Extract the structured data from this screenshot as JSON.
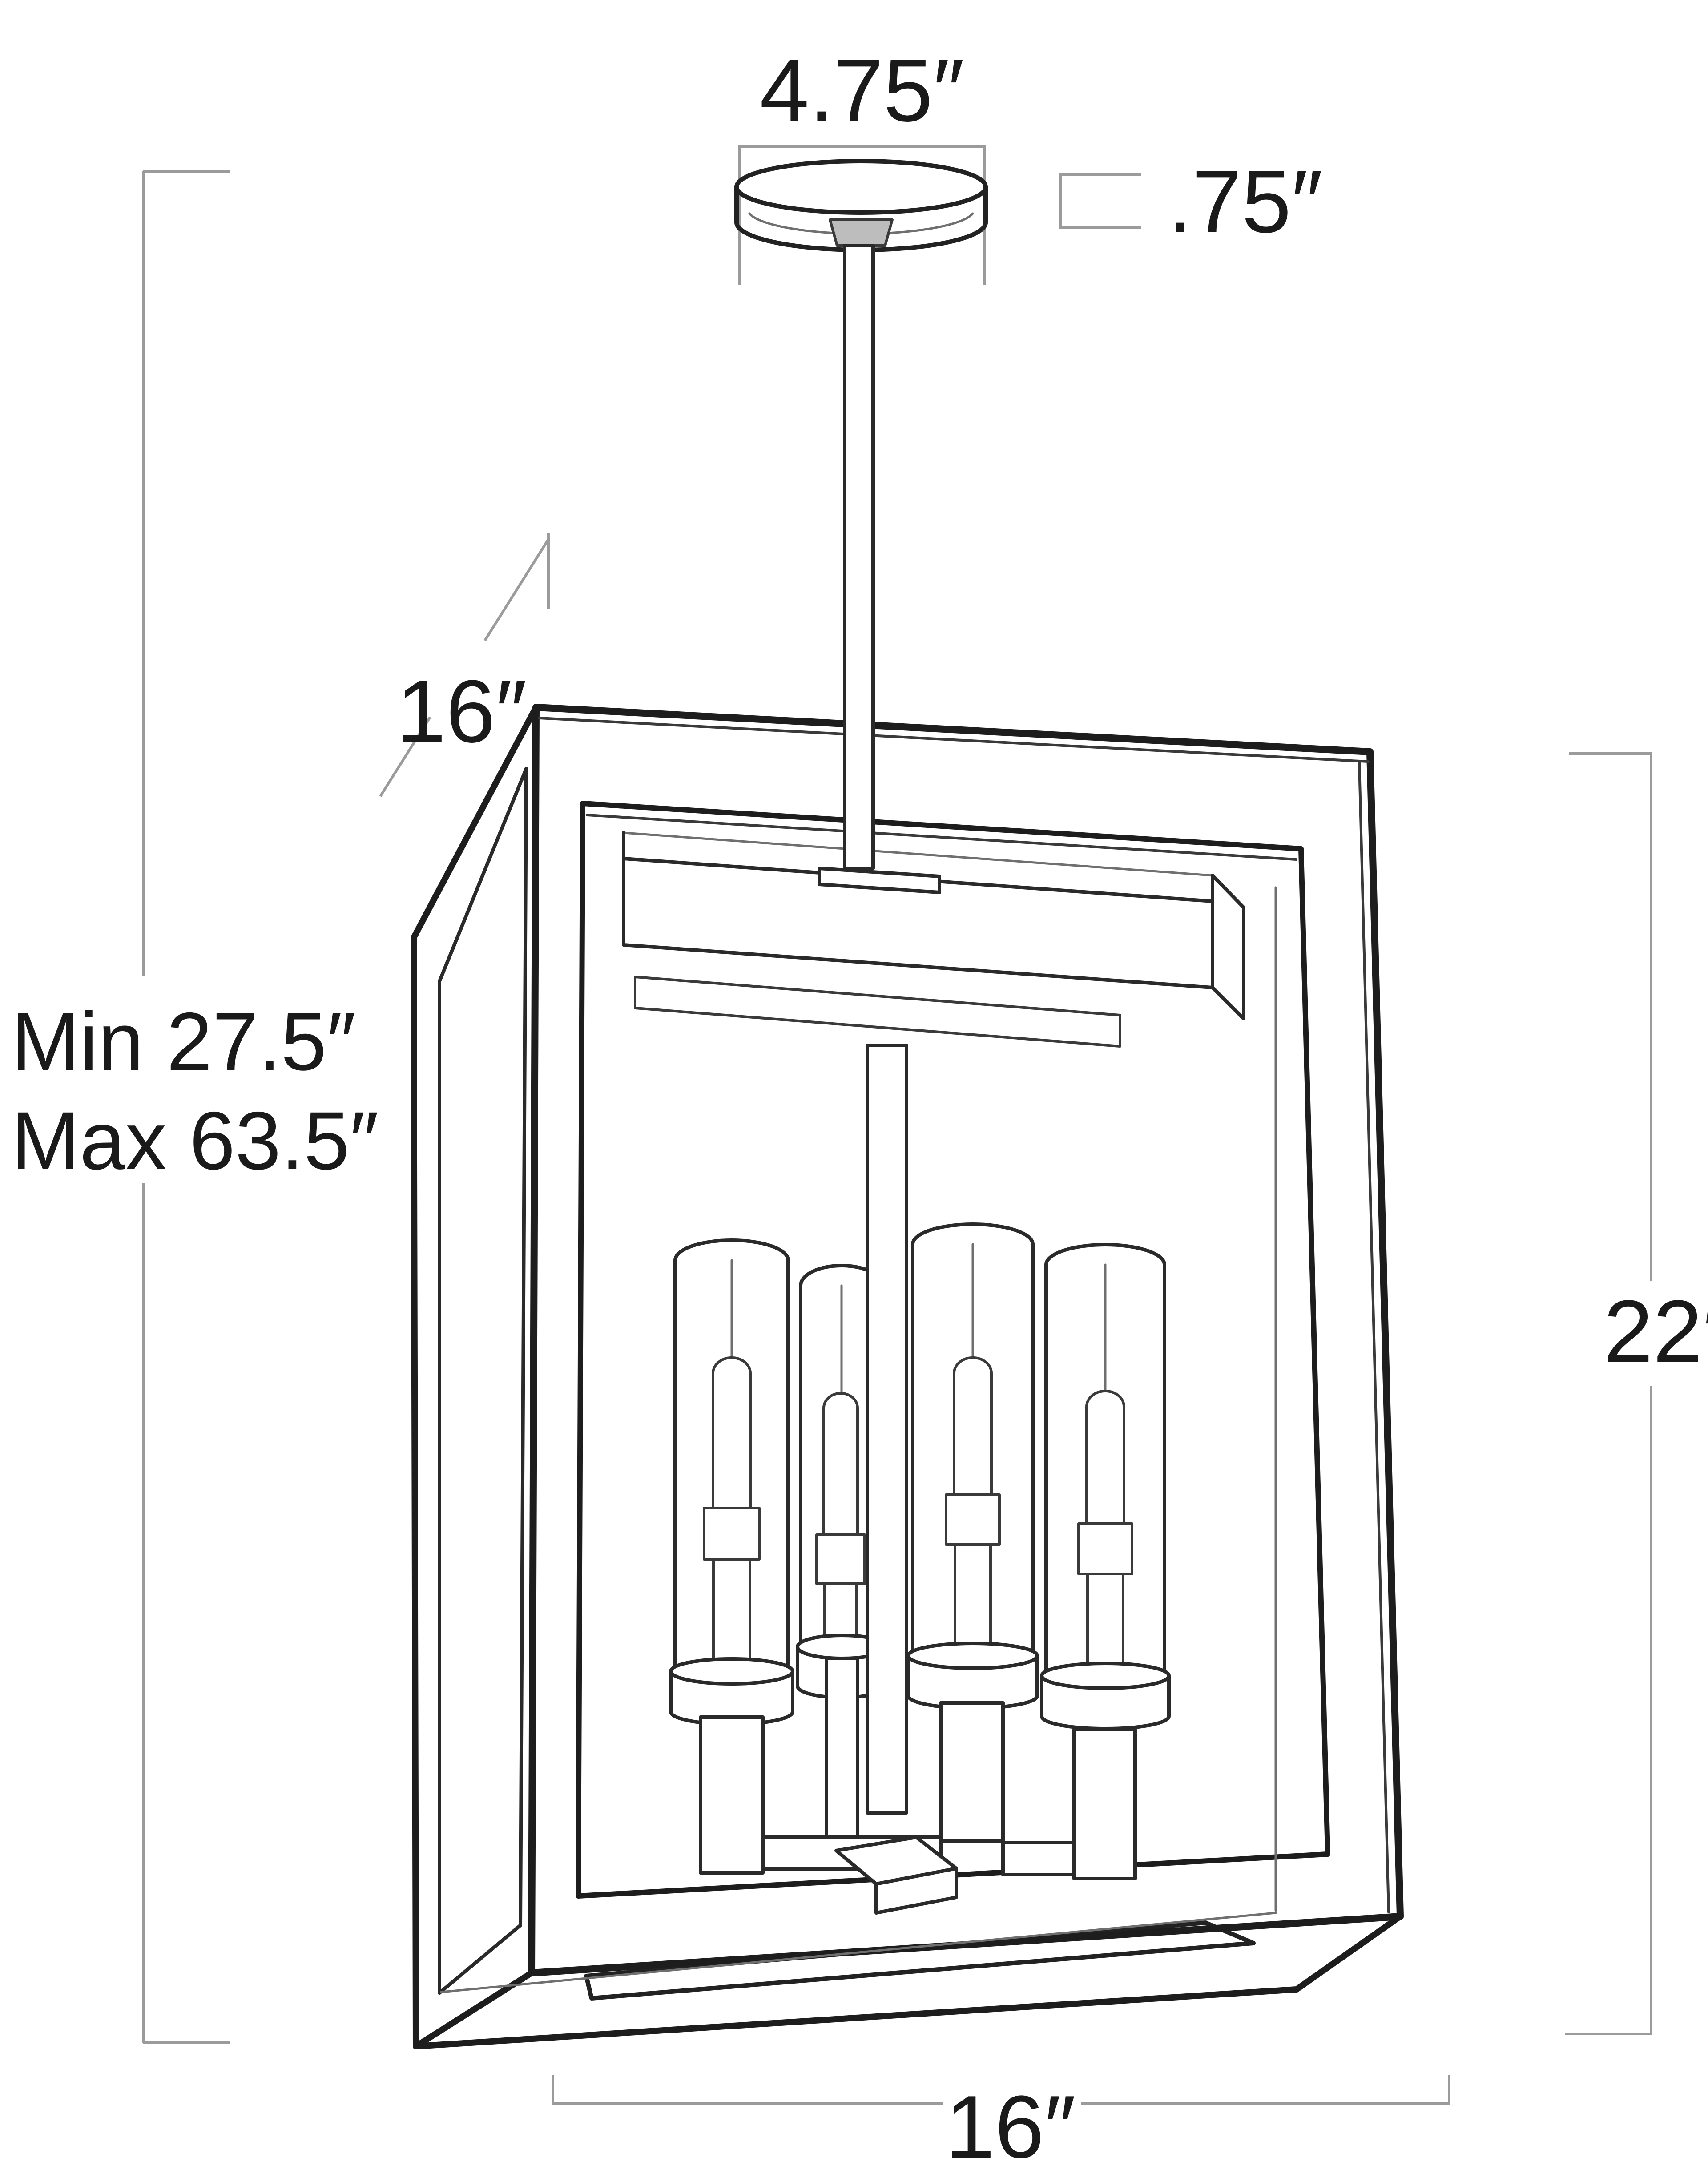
{
  "diagram": {
    "type": "pendant-light-dimension-drawing",
    "labels": {
      "canopy_width": "4.75″",
      "canopy_height": ".75″",
      "depth": "16″",
      "height_min": "Min 27.5″",
      "height_max": "Max 63.5″",
      "body_height": "22″",
      "body_width": "16″"
    },
    "colors": {
      "background": "#ffffff",
      "drawing_line": "#1d1d1d",
      "dimension_line": "#9b9b9b",
      "text": "#1a1a1a",
      "collar_fill": "#bdbdbd"
    },
    "fixture": {
      "style": "rectangular lantern pendant, open frame, 4 tubular candle lights",
      "light_count": 4
    }
  }
}
